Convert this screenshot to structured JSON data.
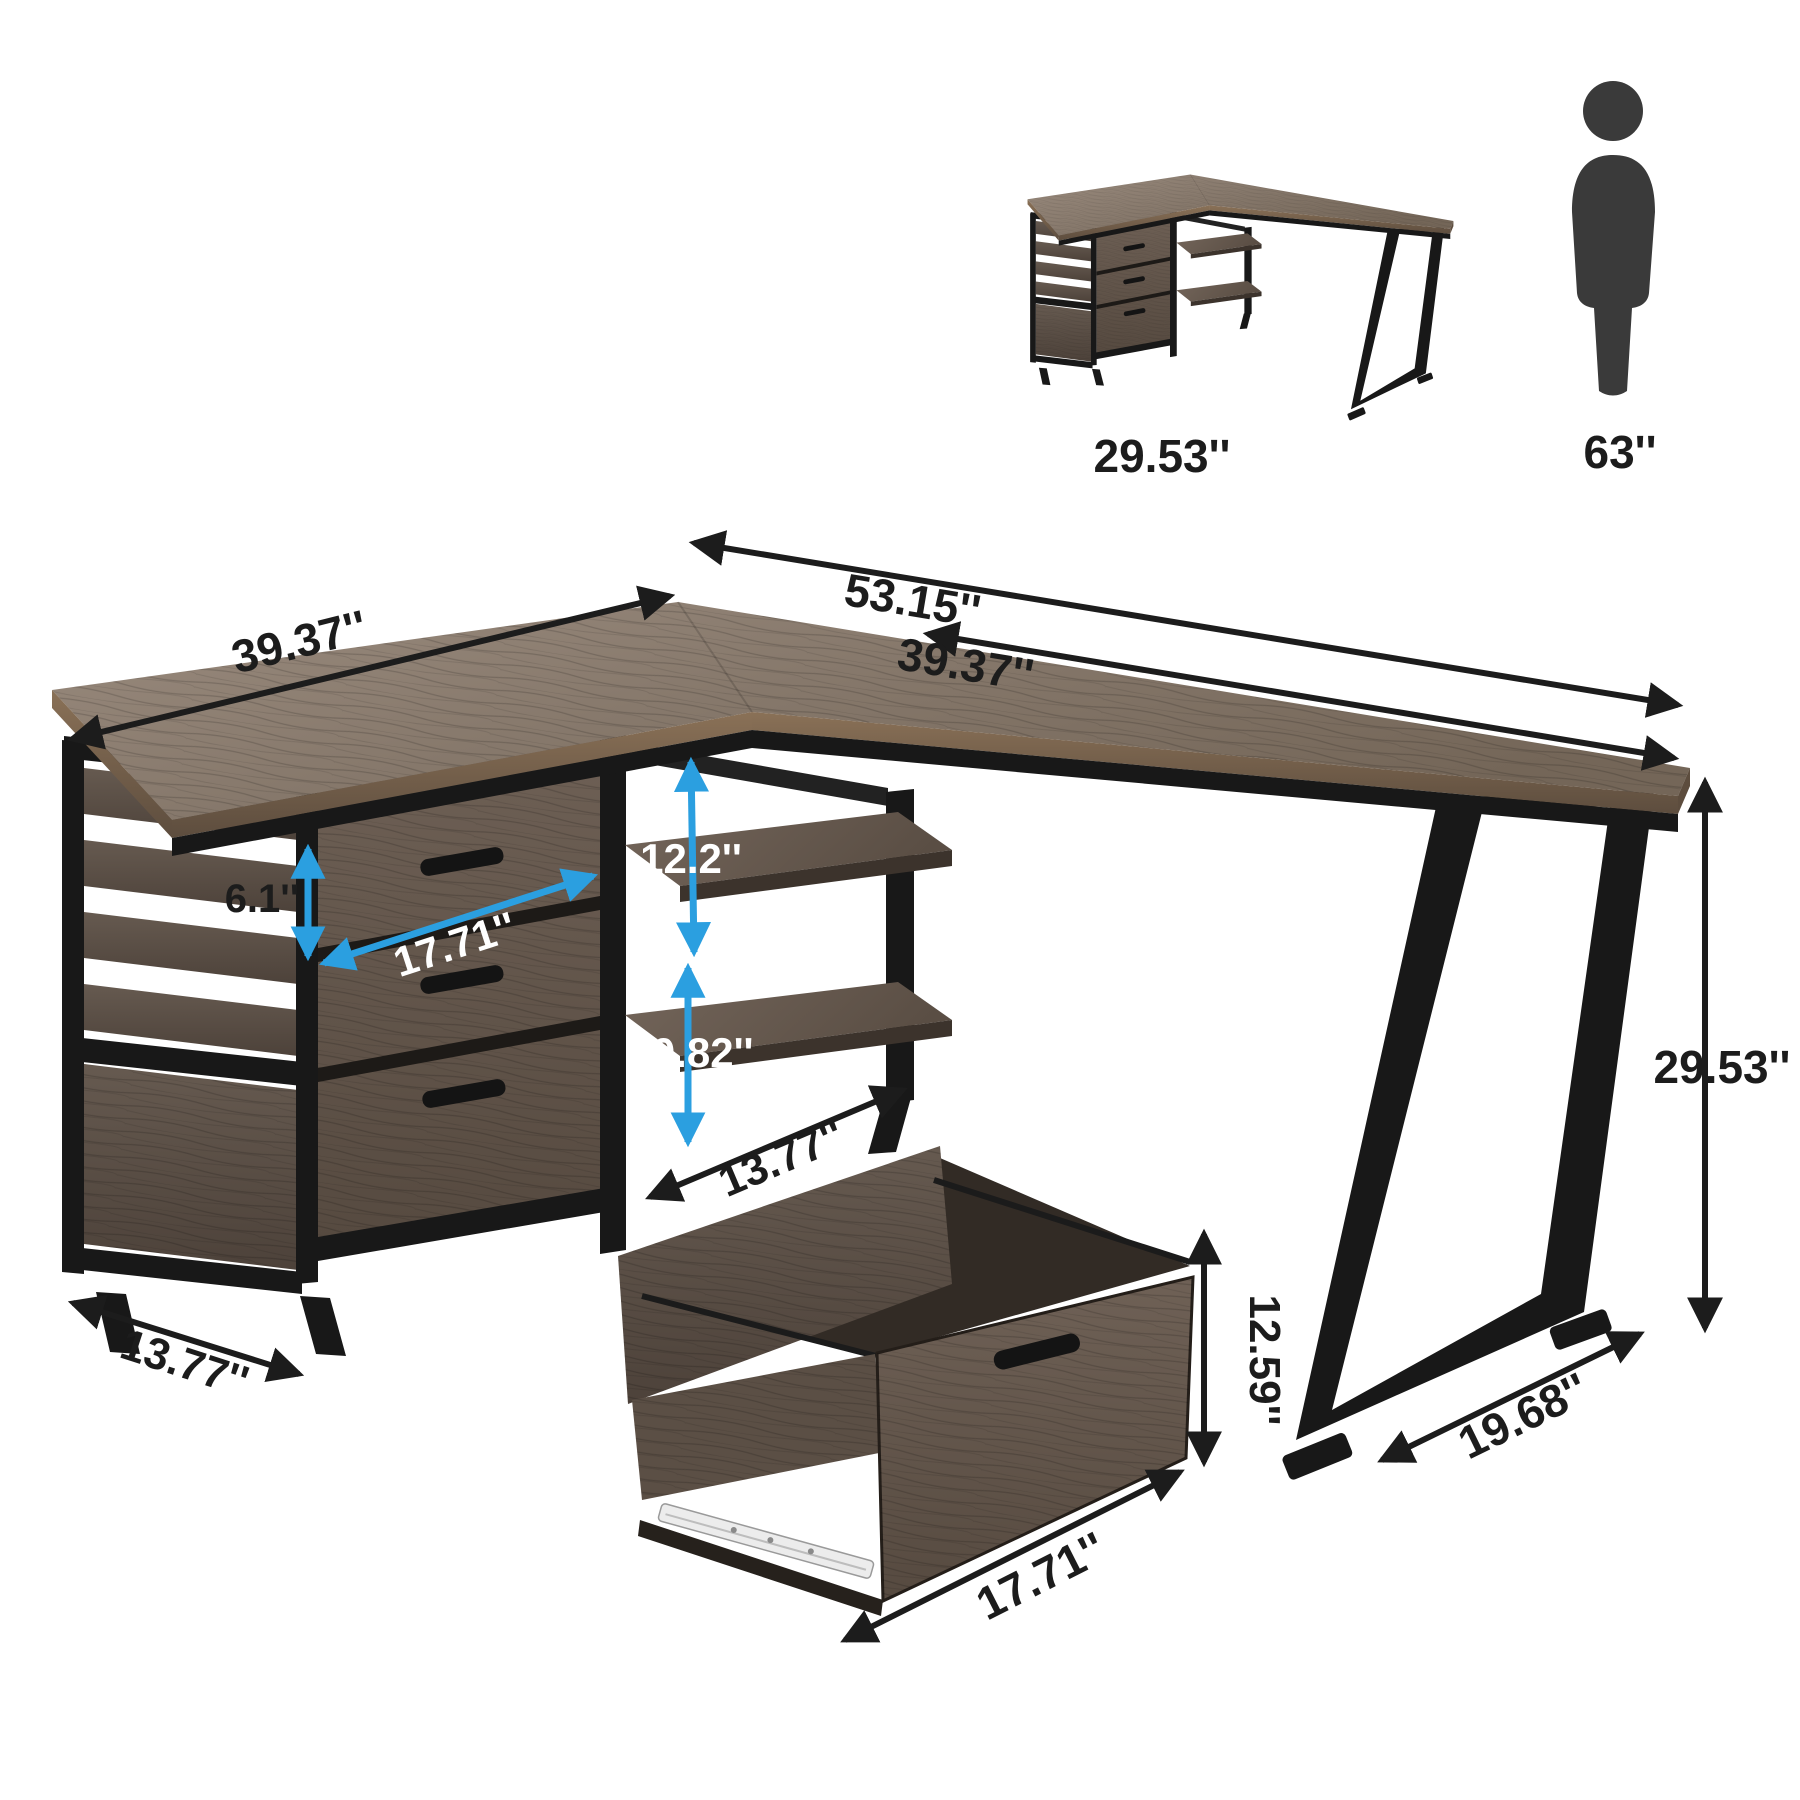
{
  "product": "L-shaped desk with file drawers - dimension diagram",
  "colors": {
    "background": "#ffffff",
    "arrow_black": "#1c1c1c",
    "arrow_blue": "#2b9fe0",
    "frame_black": "#181818",
    "wood_top_light": "#98897c",
    "wood_top_dark": "#77695d",
    "wood_front": "#685a4f",
    "wood_side": "#5d5047",
    "interior_dark": "#322b25",
    "person_gray": "#3a3a3a",
    "text_dark": "#1c1c1c",
    "text_light": "#ffffff"
  },
  "icons": {
    "person": "standing-person-icon"
  },
  "reference": {
    "assembled_desk_height": "29.53''",
    "person_height": "63''"
  },
  "dimensions": {
    "desktop_total_length": "53.15''",
    "left_wing_length": "39.37''",
    "right_wing_length": "39.37''",
    "top_drawer_height": "6.1''",
    "drawer_unit_width": "17.71''",
    "upper_shelf_height": "12.2''",
    "lower_shelf_height": "10.82''",
    "shelf_depth": "13.77''",
    "cabinet_depth": "13.77''",
    "desk_height": "29.53''",
    "leg_base_depth": "19.68''",
    "file_drawer_height": "12.59''",
    "file_drawer_width": "17.71''"
  }
}
